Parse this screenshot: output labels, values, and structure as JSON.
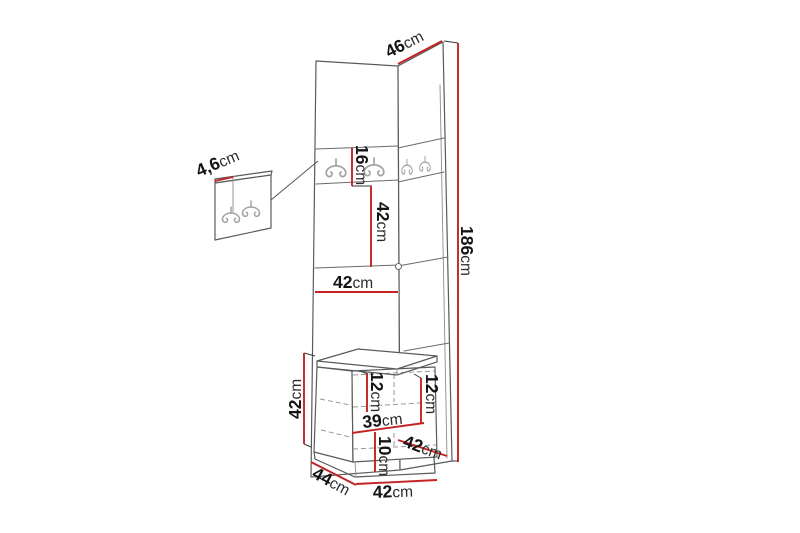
{
  "diagram": {
    "type": "furniture-dimension-drawing",
    "subject": "corner hallway unit with hook panels and seat bench",
    "unit": "cm",
    "colors": {
      "dimension_line": "#c42222",
      "outline": "#5a5a5a",
      "hooks": "#a3a3a3",
      "background": "#ffffff",
      "label_text": "#141414"
    },
    "dimensions": {
      "top_width": {
        "value": "46",
        "unit": "cm"
      },
      "total_height": {
        "value": "186",
        "unit": "cm"
      },
      "hook_strip_height": {
        "value": "16",
        "unit": "cm"
      },
      "upper_section_height": {
        "value": "42",
        "unit": "cm"
      },
      "panel_width": {
        "value": "42",
        "unit": "cm"
      },
      "hook_board_thickness": {
        "value": "4,6",
        "unit": "cm"
      },
      "bench_height": {
        "value": "42",
        "unit": "cm"
      },
      "bench_inner_top_left": {
        "value": "12",
        "unit": "cm"
      },
      "bench_inner_top_right": {
        "value": "12",
        "unit": "cm"
      },
      "bench_inner_width": {
        "value": "39",
        "unit": "cm"
      },
      "bench_inner_lower": {
        "value": "10",
        "unit": "cm"
      },
      "bench_depth_right": {
        "value": "42",
        "unit": "cm"
      },
      "bench_side_depth": {
        "value": "44",
        "unit": "cm"
      },
      "bench_width": {
        "value": "42",
        "unit": "cm"
      }
    }
  }
}
